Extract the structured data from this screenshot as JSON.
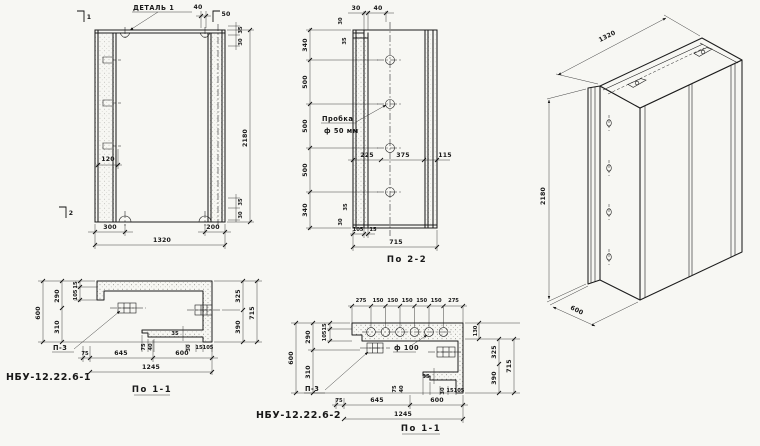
{
  "drawing": {
    "front": {
      "detail_label": "ДЕТАЛЬ 1",
      "marker_1": "1",
      "marker_2": "2",
      "top_dims": [
        "40",
        "50"
      ],
      "top_right_dims": [
        "35",
        "30"
      ],
      "bottom_right_dims": [
        "35",
        "30"
      ],
      "left_dim": "120",
      "bottom_dims": [
        "300",
        "200",
        "1320"
      ],
      "height_dim": "2180"
    },
    "section2": {
      "title": "По 2-2",
      "top_dims": [
        "30",
        "40"
      ],
      "upper_side_dims": [
        "30",
        "35"
      ],
      "left_dims": [
        "340",
        "500",
        "500",
        "500",
        "340"
      ],
      "lower_side_dims": [
        "35",
        "30"
      ],
      "plug_line1": "Пробка",
      "plug_line2": "ф 50 мм",
      "mid_dims": [
        "225",
        "375",
        "115"
      ],
      "bottom_dims": [
        "105",
        "15",
        "715"
      ]
    },
    "iso": {
      "width_dim": "1320",
      "height_dim": "2180",
      "depth_dim": "600"
    },
    "s1a": {
      "part_label": "НБУ-12.22.6-1",
      "title": "По 1-1",
      "plate_label": "П-3",
      "left_dims": [
        "600",
        "290",
        "310"
      ],
      "left_small_dims": [
        "15",
        "105"
      ],
      "right_dims": [
        "325",
        "390",
        "715"
      ],
      "step_dims": [
        "35",
        "75",
        "40",
        "30",
        "15",
        "105"
      ],
      "bottom_dims": [
        "75",
        "645",
        "600",
        "1245"
      ]
    },
    "s1b": {
      "part_label": "НБУ-12.22.6-2",
      "title": "По 1-1",
      "plate_label": "П-3",
      "hole_label": "ф 100",
      "top_dims": [
        "275",
        "150",
        "150",
        "150",
        "150",
        "150",
        "275"
      ],
      "left_dims": [
        "600",
        "290",
        "310"
      ],
      "left_small_dims": [
        "15",
        "105"
      ],
      "right_dims": [
        "130",
        "325",
        "390",
        "715"
      ],
      "step_dims": [
        "35",
        "75",
        "40",
        "30",
        "15",
        "105"
      ],
      "bottom_dims": [
        "75",
        "645",
        "600",
        "1245"
      ]
    }
  }
}
